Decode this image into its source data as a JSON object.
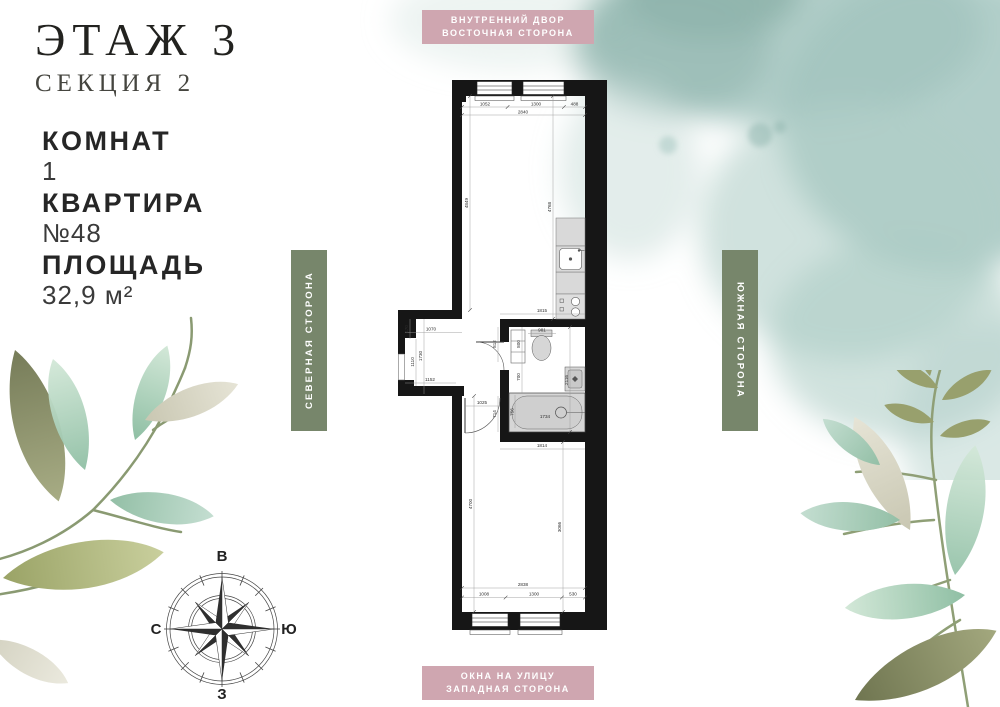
{
  "info": {
    "floor_title": "ЭТАЖ 3",
    "section_subtitle": "СЕКЦИЯ 2",
    "rooms_label": "КОМНАТ",
    "rooms_value": "1",
    "apartment_label": "КВАРТИРА",
    "apartment_value": "№48",
    "area_label": "ПЛОЩАДЬ",
    "area_value": "32,9 м²"
  },
  "badges": {
    "top": {
      "line1": "ВНУТРЕННИЙ ДВОР",
      "line2": "ВОСТОЧНАЯ СТОРОНА",
      "bg": "#cfa6b0"
    },
    "bottom": {
      "line1": "ОКНА НА УЛИЦУ",
      "line2": "ЗАПАДНАЯ СТОРОНА",
      "bg": "#cfa6b0"
    },
    "left": {
      "label": "СЕВЕРНАЯ СТОРОНА",
      "bg": "#77866b"
    },
    "right": {
      "label": "ЮЖНАЯ СТОРОНА",
      "bg": "#77866b"
    }
  },
  "compass": {
    "top": "В",
    "right": "Ю",
    "bottom": "З",
    "left": "С"
  },
  "plan": {
    "colors": {
      "wall": "#161616",
      "fixture_fill": "#d6d6d6",
      "dim_text": "#2e2e2e"
    },
    "dimensions": [
      {
        "t": "1052",
        "x": 87,
        "y": 25.3
      },
      {
        "t": "1300",
        "x": 138,
        "y": 25.3
      },
      {
        "t": "488",
        "x": 176.5,
        "y": 25.3
      },
      {
        "t": "2840",
        "x": 125,
        "y": 33.3
      },
      {
        "t": "4849",
        "x": 70,
        "y": 123,
        "r": -90
      },
      {
        "t": "4768",
        "x": 153,
        "y": 127,
        "r": -90
      },
      {
        "t": "1815",
        "x": 144,
        "y": 232
      },
      {
        "t": "981",
        "x": 144,
        "y": 251.5
      },
      {
        "t": "800",
        "x": 122,
        "y": 264,
        "r": -90
      },
      {
        "t": "700",
        "x": 122,
        "y": 297,
        "r": -90
      },
      {
        "t": "2116",
        "x": 170,
        "y": 300,
        "r": -90
      },
      {
        "t": "812",
        "x": 98,
        "y": 264,
        "r": -90
      },
      {
        "t": "714",
        "x": 98,
        "y": 334,
        "r": -90
      },
      {
        "t": "756",
        "x": 115.5,
        "y": 332,
        "r": -90
      },
      {
        "t": "1734",
        "x": 147,
        "y": 338
      },
      {
        "t": "1070",
        "x": 33,
        "y": 250.5
      },
      {
        "t": "470",
        "x": 10,
        "y": 249,
        "r": -90
      },
      {
        "t": "1730",
        "x": 24,
        "y": 276,
        "r": -90
      },
      {
        "t": "1110",
        "x": 16,
        "y": 282,
        "r": -90
      },
      {
        "t": "1152",
        "x": 32,
        "y": 301
      },
      {
        "t": "1025",
        "x": 84,
        "y": 324
      },
      {
        "t": "1814",
        "x": 144,
        "y": 367
      },
      {
        "t": "4700",
        "x": 74,
        "y": 424,
        "r": -90
      },
      {
        "t": "3066",
        "x": 163,
        "y": 447,
        "r": -90
      },
      {
        "t": "2838",
        "x": 125,
        "y": 506
      },
      {
        "t": "1008",
        "x": 86,
        "y": 515.5
      },
      {
        "t": "1300",
        "x": 136,
        "y": 515.5
      },
      {
        "t": "530",
        "x": 175,
        "y": 515.5
      }
    ]
  }
}
